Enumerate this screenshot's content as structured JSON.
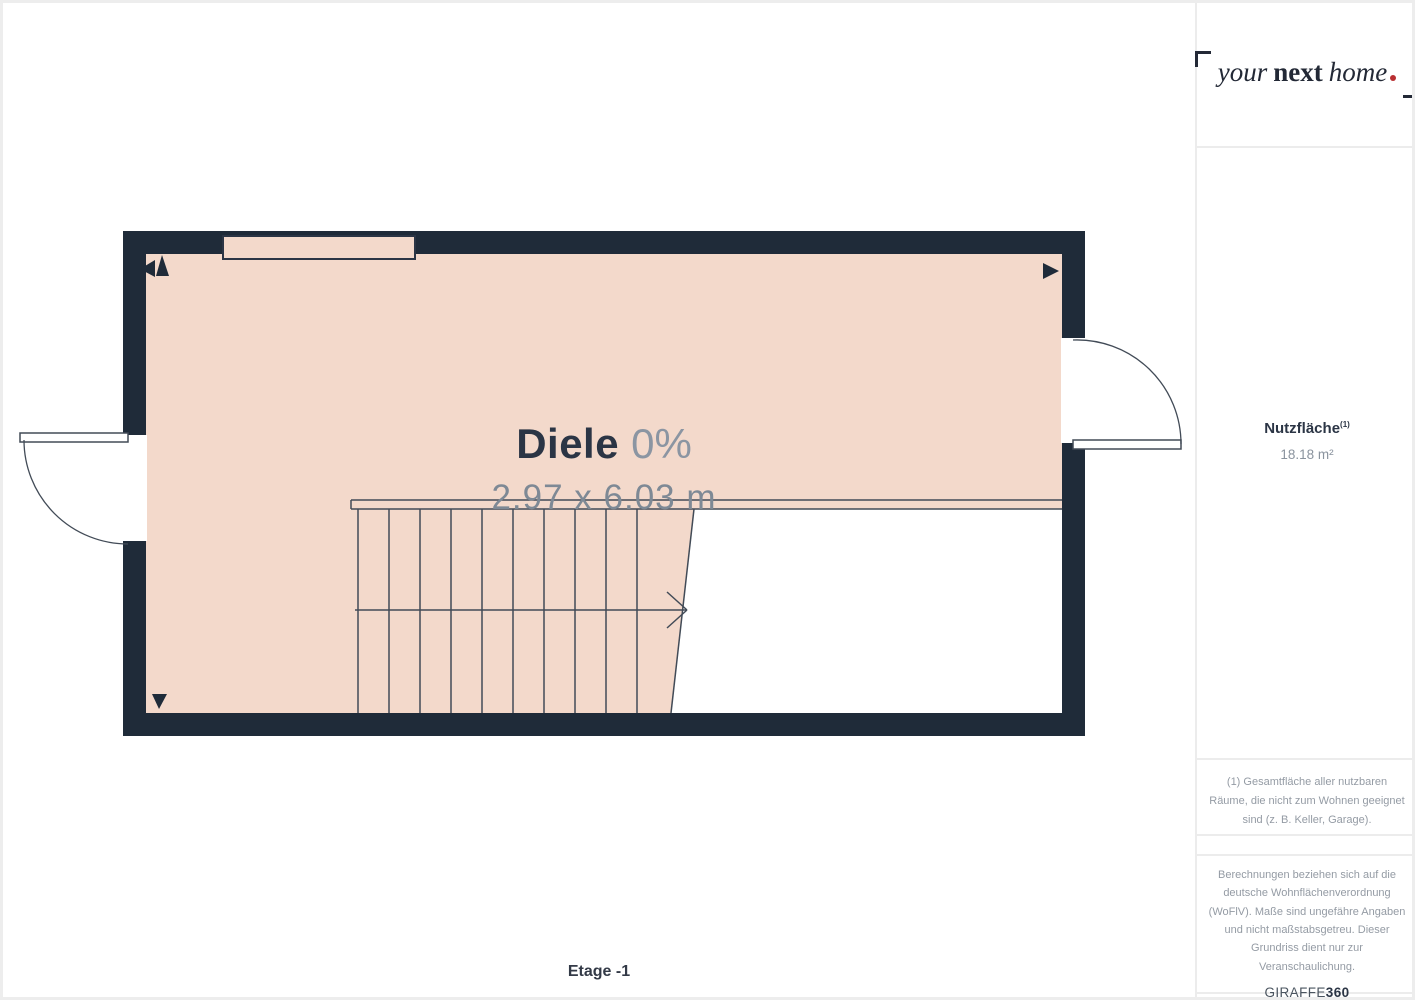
{
  "floorplan": {
    "room": {
      "name": "Diele",
      "percent": "0%",
      "dimensions": "2.97 x 6.03 m"
    },
    "floor_label": "Etage -1",
    "colors": {
      "wall": "#1f2b39",
      "floor": "#f3d9cb",
      "line": "#424b57",
      "label_dark": "#2b3545",
      "label_muted": "#7e8995"
    }
  },
  "sidebar": {
    "logo": {
      "word1": "your",
      "word2": "next",
      "word3": "home",
      "dot_color": "#b92f32"
    },
    "area": {
      "label": "Nutzfläche",
      "superscript": "(1)",
      "value": "18.18 m²"
    },
    "footnote": "(1) Gesamtfläche aller nutzbaren Räume, die nicht zum Wohnen geeignet sind (z. B. Keller, Garage).",
    "disclaimer": "Berechnungen beziehen sich auf die deutsche Wohnflächenverordnung (WoFlV). Maße sind ungefähre Angaben und nicht maßstabsgetreu. Dieser Grundriss dient nur zur Veranschaulichung.",
    "brand": {
      "name": "GIRAFFE",
      "number": "360"
    }
  }
}
